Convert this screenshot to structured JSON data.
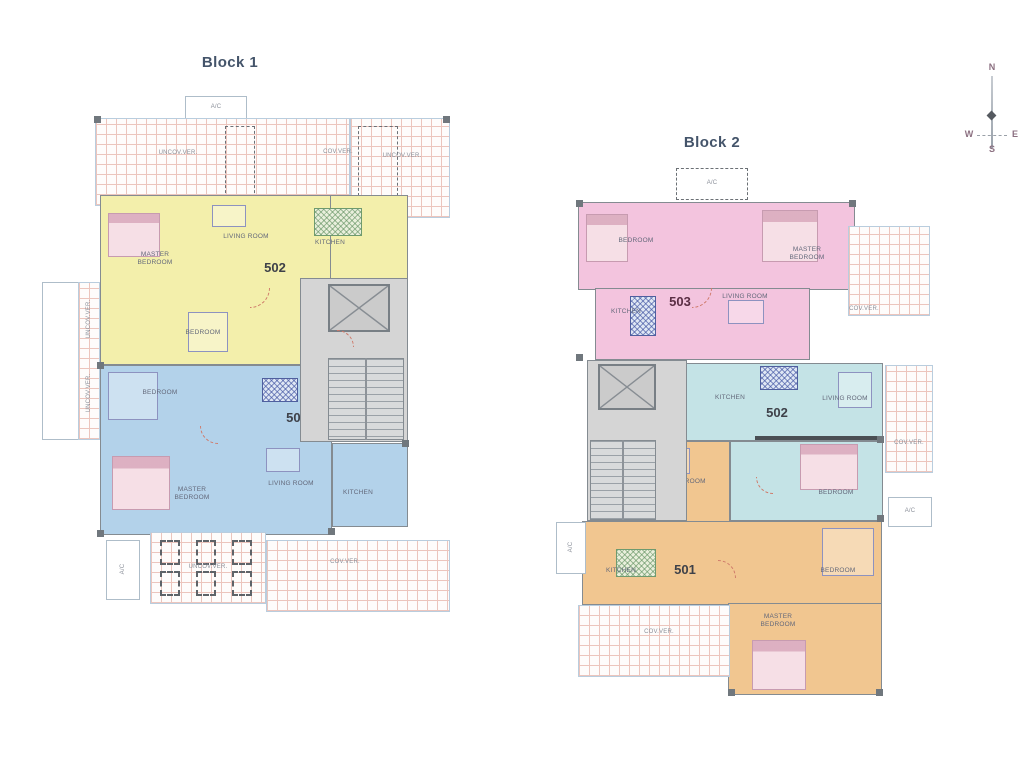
{
  "compass": {
    "north": "N",
    "west": "W",
    "east": "E",
    "south": "S"
  },
  "block1": {
    "title": "Block 1",
    "labels": {
      "ac_top": "A/C",
      "ac_bottom": "A/C",
      "ver_top_left": "UNCOV.VER.",
      "ver_top_mid": "COV.VER.",
      "ver_top_right": "UNCOV.VER.",
      "ver_left_upper": "UNCOV.VER.",
      "ver_left_lower": "UNCOV.VER.",
      "pergola": "UNCOV.VER.",
      "ver_bottom": "COV.VER."
    },
    "apt502": {
      "number": "502",
      "master_bedroom": "MASTER BEDROOM",
      "living_room": "LIVING ROOM",
      "kitchen": "KITCHEN",
      "bedroom": "BEDROOM"
    },
    "apt501": {
      "number": "501",
      "bedroom": "BEDROOM",
      "master_bedroom": "MASTER BEDROOM",
      "living_room": "LIVING ROOM",
      "kitchen": "KITCHEN"
    }
  },
  "block2": {
    "title": "Block 2",
    "labels": {
      "ac_top": "A/C",
      "ac_left": "A/C",
      "ac_right": "A/C",
      "ver_right_upper": "COV.VER.",
      "ver_right_mid": "COV.VER.",
      "ver_bottom": "COV.VER."
    },
    "apt503": {
      "number": "503",
      "bedroom": "BEDROOM",
      "master_bedroom": "MASTER BEDROOM",
      "kitchen": "KITCHEN",
      "living_room": "LIVING ROOM"
    },
    "apt502": {
      "number": "502",
      "kitchen": "KITCHEN",
      "living_room": "LIVING ROOM",
      "bedroom": "BEDROOM"
    },
    "apt501": {
      "number": "501",
      "living_room": "LIVING ROOM",
      "kitchen": "KITCHEN",
      "bedroom": "BEDROOM",
      "master_bedroom": "MASTER BEDROOM"
    }
  },
  "colors": {
    "apt_yellow": "#f3efab",
    "apt_blue": "#b3d2ea",
    "apt_pink": "#f3c4de",
    "apt_teal": "#c4e3e6",
    "apt_orange": "#f1c690",
    "wall": "#848b91",
    "core_gray": "#d5d5d5",
    "hatch_line": "#ecc5bd",
    "title_text": "#44546a",
    "door_arc": "#cf7a6a"
  }
}
